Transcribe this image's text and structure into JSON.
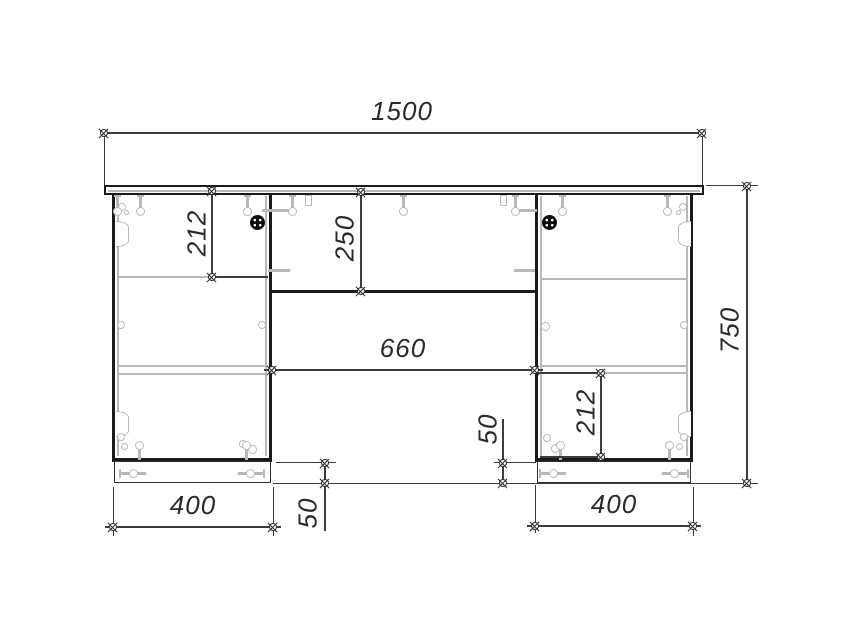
{
  "drawing": {
    "background_color": "#ffffff",
    "outline_color": "#1a1a1a",
    "dimension_color": "#3c3c3c",
    "hardware_color": "#b9b9b9",
    "knob_color": "#0d0d0d",
    "dimensions": {
      "total_width": "1500",
      "total_height": "750",
      "left_drawer_front_height": "212",
      "apron_height": "250",
      "kneehole_width": "660",
      "right_drawer_front_height": "212",
      "plinth_height_center": "50",
      "plinth_height_left": "50",
      "left_pedestal_width": "400",
      "right_pedestal_width": "400"
    }
  }
}
